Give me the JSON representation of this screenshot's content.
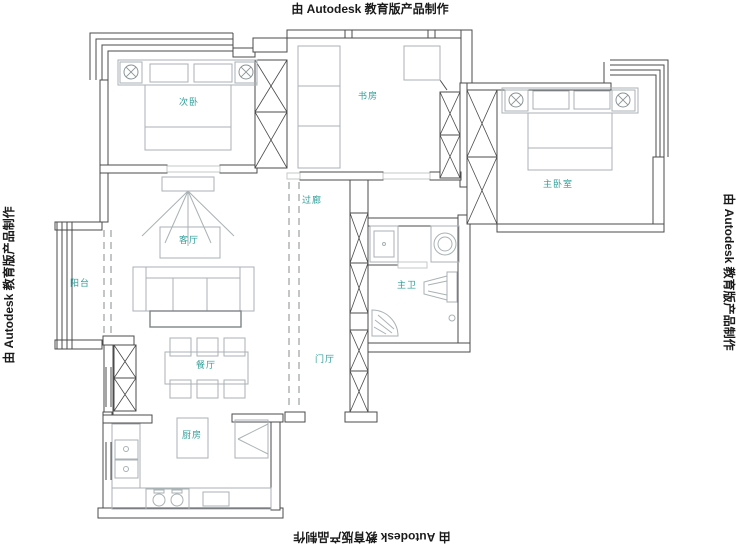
{
  "watermark": {
    "text": "由 Autodesk 教育版产品制作"
  },
  "rooms": {
    "secondary_bedroom": {
      "label": "次卧"
    },
    "study": {
      "label": "书房"
    },
    "master_bedroom": {
      "label": "主卧室"
    },
    "corridor": {
      "label": "过廊"
    },
    "living_room": {
      "label": "客厅"
    },
    "balcony": {
      "label": "阳台"
    },
    "master_bath": {
      "label": "主卫"
    },
    "entry_hall": {
      "label": "门厅"
    },
    "dining_room": {
      "label": "餐厅"
    },
    "kitchen": {
      "label": "厨房"
    }
  },
  "colors": {
    "wall": "#4b4b4b",
    "furniture": "#a9b2b4",
    "dashed": "#9aa0a0",
    "room_label": "#2f9e99",
    "watermark": "#1a1a1a"
  }
}
